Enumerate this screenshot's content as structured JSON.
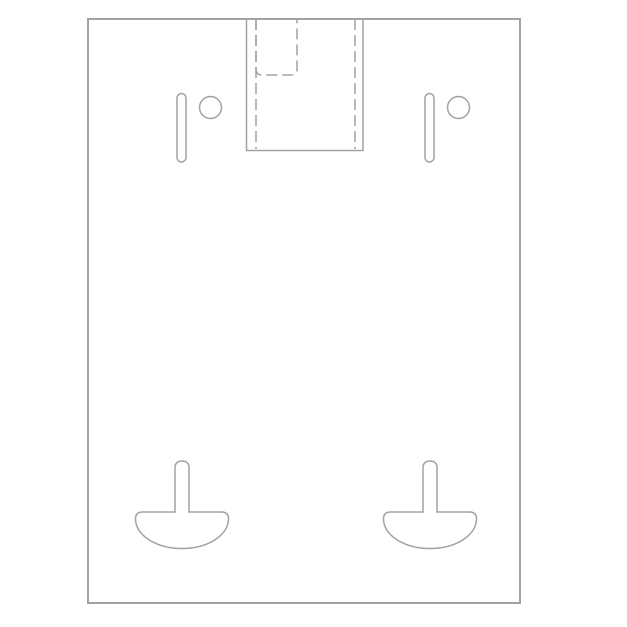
{
  "page": {
    "background_color": "#ffffff"
  },
  "drawing": {
    "title": "wall-mount-bracket-plate-front-view",
    "canvas": {
      "width": 627,
      "height": 627
    },
    "style": {
      "line_color": "#a2a2a2",
      "outline_width": 2,
      "feature_width": 1.5,
      "hidden_dash": "11 5",
      "fill": "#ffffff"
    },
    "plate_outline": {
      "name": "plate-outline",
      "x": 88,
      "y": 19,
      "width": 432,
      "height": 584
    },
    "pole_channel": {
      "name": "pole-channel",
      "left_x": 246.5,
      "right_x": 363,
      "top_y": 19,
      "bottom_y": 150.5,
      "hidden_left_x": 256,
      "hidden_right_x": 355,
      "hidden_bottom_y": 149
    },
    "hidden_tab": {
      "name": "hidden-tab",
      "left_x": 256,
      "right_x": 297,
      "top_y": 19,
      "bottom_y": 75,
      "corner_radius": 6
    },
    "mount_slots": [
      {
        "name": "mount-slot-left",
        "cx": 181.5,
        "top_y": 93.5,
        "bottom_y": 162,
        "width": 9
      },
      {
        "name": "mount-slot-right",
        "cx": 429.5,
        "top_y": 93.5,
        "bottom_y": 162,
        "width": 9
      }
    ],
    "screw_holes": [
      {
        "name": "screw-hole-left",
        "cx": 210.5,
        "cy": 107.5,
        "r": 11
      },
      {
        "name": "screw-hole-right",
        "cx": 458.5,
        "cy": 107.5,
        "r": 11
      }
    ],
    "keyhole_cutouts": [
      {
        "name": "keyhole-cutout-left",
        "cx": 182
      },
      {
        "name": "keyhole-cutout-right",
        "cx": 430
      }
    ],
    "keyhole_shape": {
      "stem_width": 14,
      "stem_top_y": 461,
      "bowl_top_y": 512,
      "bowl_half_width": 46.5,
      "bowl_bottom_y": 548.5,
      "corner_radius": 7
    }
  }
}
